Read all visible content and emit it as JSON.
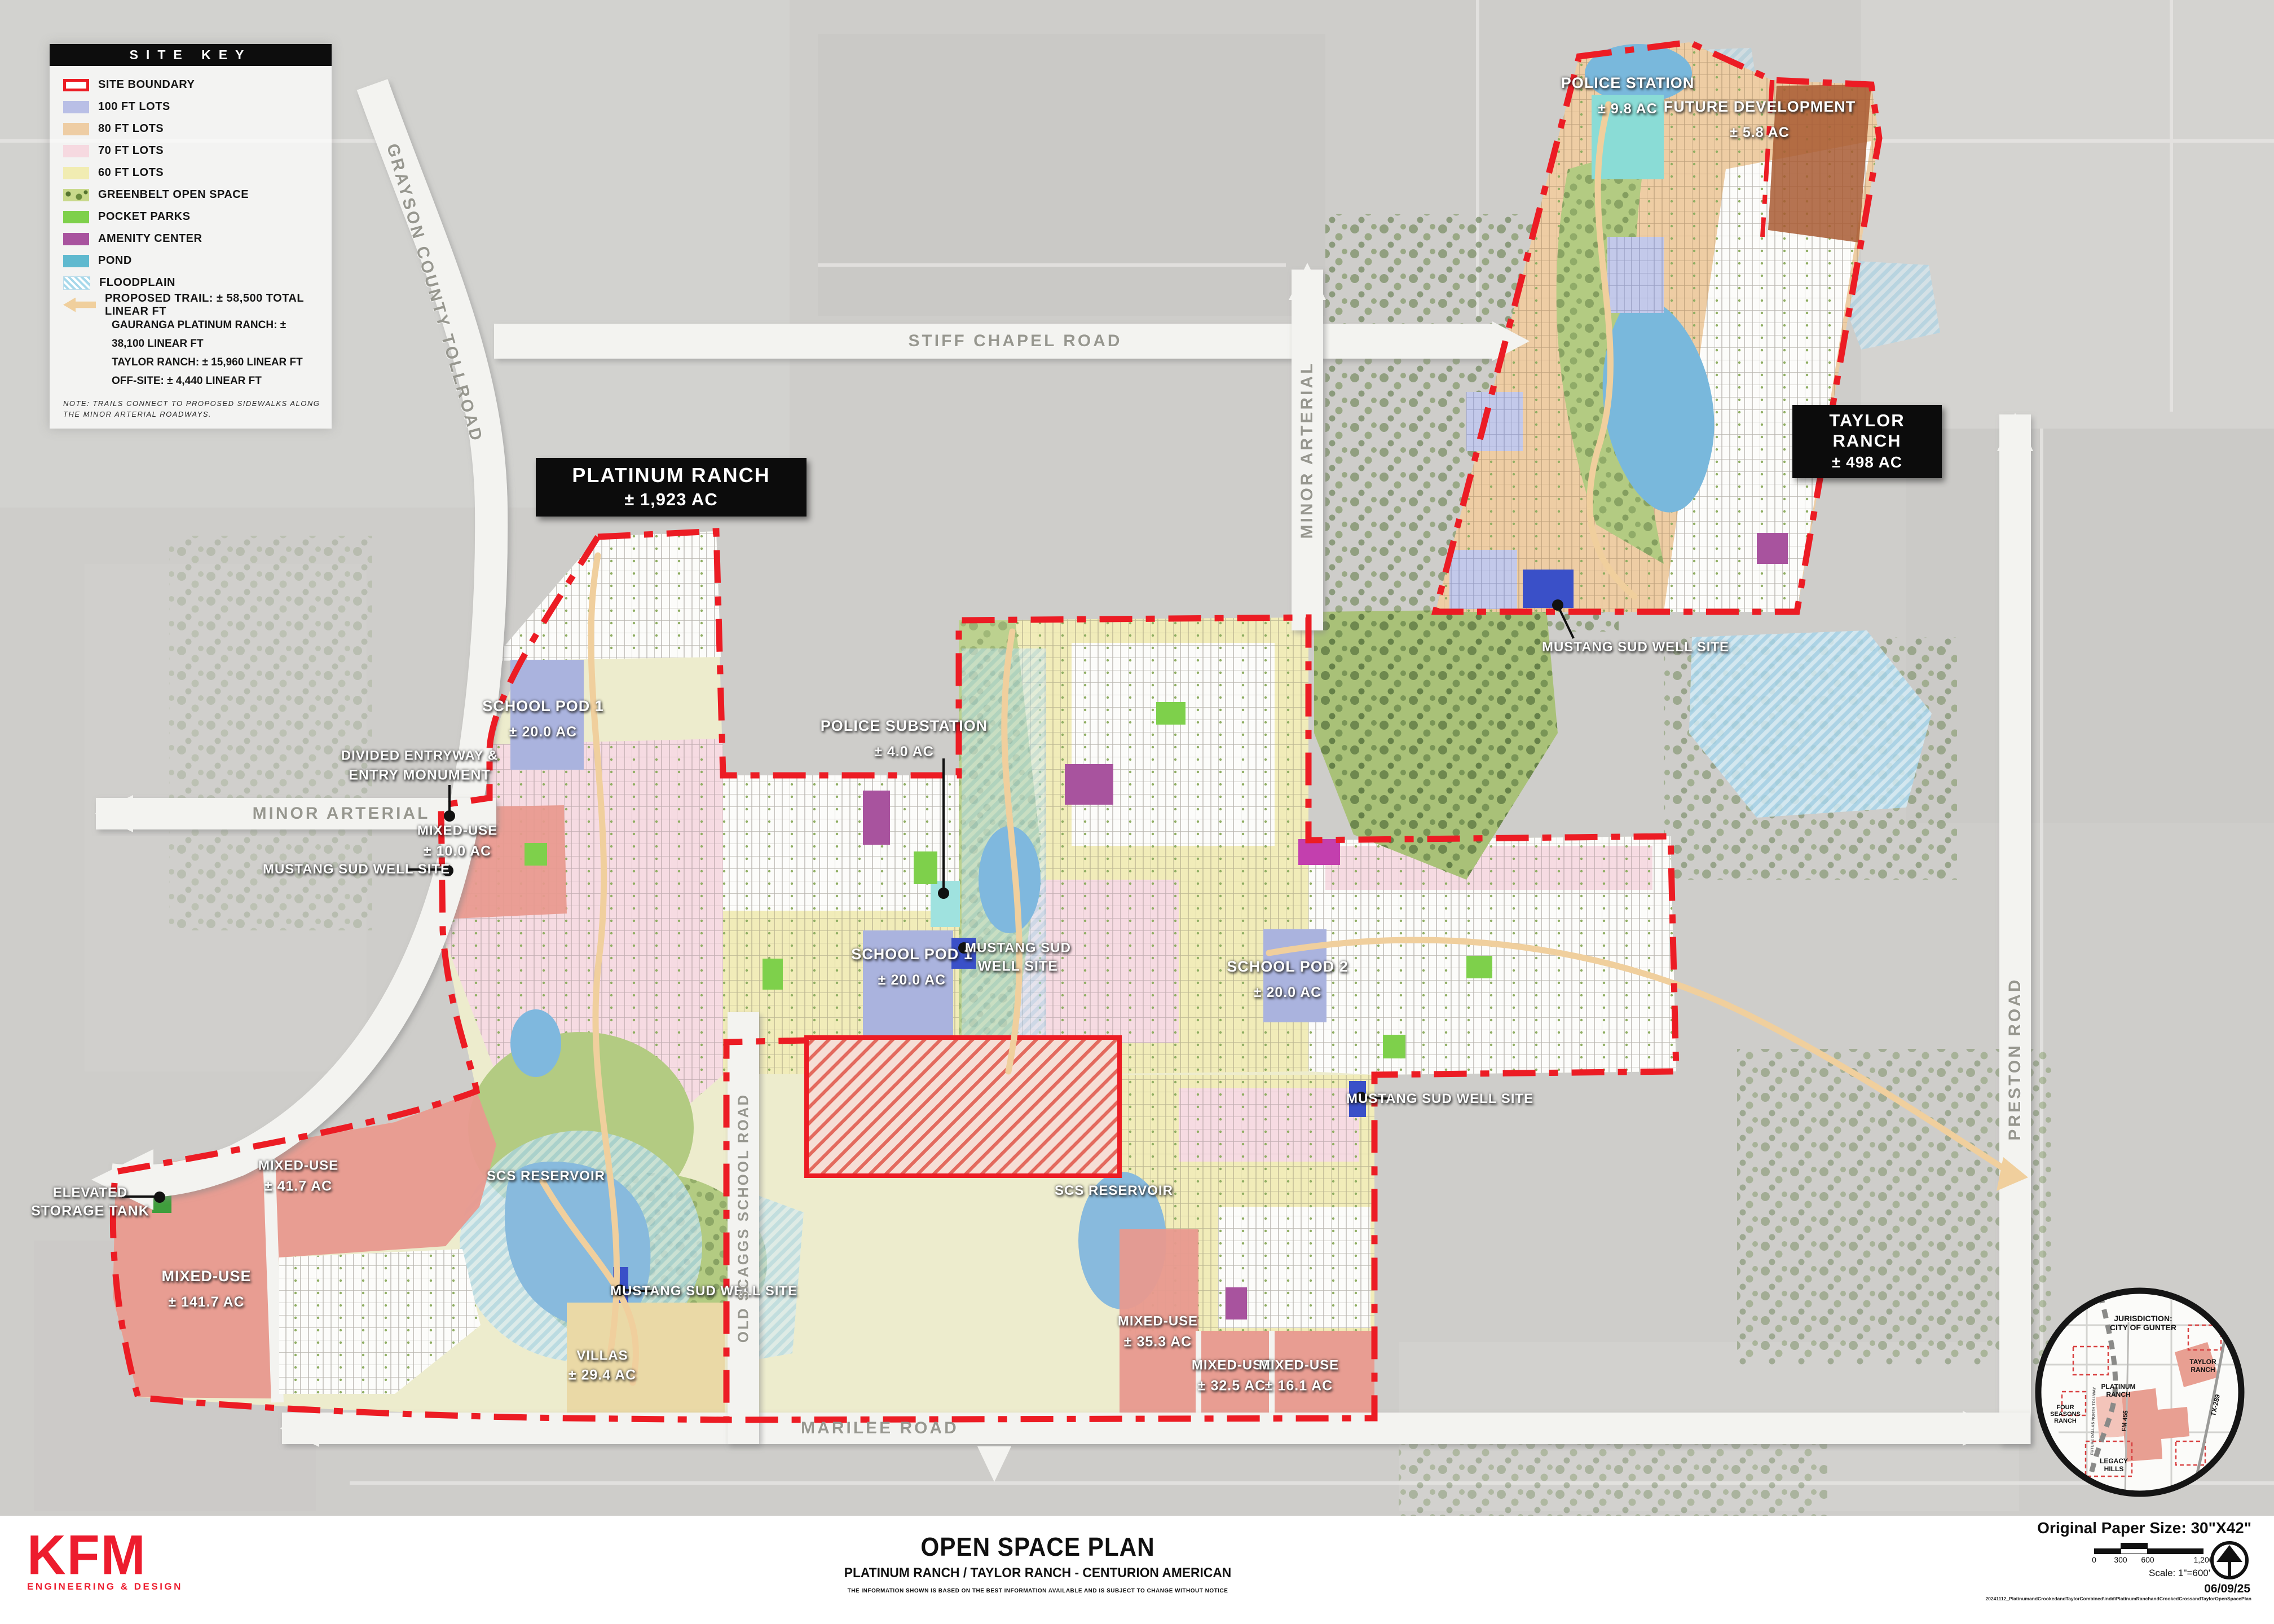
{
  "legend": {
    "title": "SITE KEY",
    "items": [
      {
        "label": "SITE BOUNDARY"
      },
      {
        "label": "100 FT LOTS"
      },
      {
        "label": "80 FT LOTS"
      },
      {
        "label": "70 FT LOTS"
      },
      {
        "label": "60 FT LOTS"
      },
      {
        "label": "GREENBELT OPEN SPACE"
      },
      {
        "label": "POCKET PARKS"
      },
      {
        "label": "AMENITY CENTER"
      },
      {
        "label": "POND"
      },
      {
        "label": "FLOODPLAIN"
      }
    ],
    "trail_label": "PROPOSED TRAIL: ± 58,500 TOTAL LINEAR FT",
    "trail_lines": [
      "GAURANGA PLATINUM RANCH: ± 38,100 LINEAR FT",
      "TAYLOR RANCH: ± 15,960 LINEAR FT",
      "OFF-SITE: ± 4,440 LINEAR FT"
    ],
    "note": "NOTE: TRAILS CONNECT TO PROPOSED SIDEWALKS ALONG THE MINOR ARTERIAL ROADWAYS."
  },
  "boxes": {
    "platinum": {
      "line1": "PLATINUM RANCH",
      "line2": "± 1,923 AC"
    },
    "taylor": {
      "line1": "TAYLOR RANCH",
      "line2": "± 498 AC"
    }
  },
  "labels": {
    "police_station": {
      "line1": "POLICE STATION",
      "line2": "± 9.8 AC"
    },
    "future_development": {
      "line1": "FUTURE DEVELOPMENT",
      "line2": "± 5.8 AC"
    },
    "mustang_taylor": {
      "line1": "MUSTANG SUD WELL SITE"
    },
    "school_pod1_north": {
      "line1": "SCHOOL POD 1",
      "line2": "± 20.0 AC"
    },
    "divided_entry": {
      "line1": "DIVIDED ENTRYWAY &",
      "line2": "ENTRY MONUMENT"
    },
    "mixed_use_10": {
      "line1": "MIXED-USE",
      "line2": "± 10.0 AC"
    },
    "mustang_west": {
      "line1": "MUSTANG SUD WELL SITE"
    },
    "police_substation": {
      "line1": "POLICE SUBSTATION",
      "line2": "± 4.0 AC"
    },
    "school_pod1_center": {
      "line1": "SCHOOL POD 1",
      "line2": "± 20.0 AC"
    },
    "mustang_center": {
      "line1": "MUSTANG SUD",
      "line2": "WELL SITE"
    },
    "school_pod2": {
      "line1": "SCHOOL POD 2",
      "line2": "± 20.0 AC"
    },
    "mustang_east": {
      "line1": "MUSTANG SUD WELL SITE"
    },
    "scs_west": {
      "line1": "SCS RESERVOIR"
    },
    "mixed_use_41": {
      "line1": "MIXED-USE",
      "line2": "± 41.7 AC"
    },
    "elevated_tank": {
      "line1": "ELEVATED",
      "line2": "STORAGE TANK"
    },
    "mixed_use_141": {
      "line1": "MIXED-USE",
      "line2": "± 141.7 AC"
    },
    "villas": {
      "line1": "VILLAS",
      "line2": "± 29.4 AC"
    },
    "mustang_south": {
      "line1": "MUSTANG SUD WELL SITE"
    },
    "scs_east": {
      "line1": "SCS RESERVOIR"
    },
    "mixed_use_35": {
      "line1": "MIXED-USE",
      "line2": "± 35.3 AC"
    },
    "mixed_use_32": {
      "line1": "MIXED-USE",
      "line2": "± 32.5 AC"
    },
    "mixed_use_16": {
      "line1": "MIXED-USE",
      "line2": "± 16.1 AC"
    }
  },
  "roads": {
    "grayson": "GRAYSON COUNTY TOLLROAD",
    "stiff_chapel": "STIFF CHAPEL ROAD",
    "minor_arterial_v": "MINOR ARTERIAL",
    "minor_arterial_h": "MINOR ARTERIAL",
    "preston": "PRESTON ROAD",
    "marilee": "MARILEE ROAD",
    "old_scaggs": "OLD SCAGGS SCHOOL ROAD"
  },
  "inset": {
    "jurisdiction_line1": "JURISDICTION:",
    "jurisdiction_line2": "CITY OF GUNTER",
    "taylor": "TAYLOR RANCH",
    "platinum": "PLATINUM RANCH",
    "four_seasons": "FOUR SEASONS RANCH",
    "legacy_hills": "LEGACY HILLS",
    "fm455": "FM 455",
    "tx289": "TX-289",
    "tollway": "FUTURE DALLAS NORTH TOLLWAY"
  },
  "footer": {
    "logo_line1": "KFM",
    "logo_line2": "ENGINEERING & DESIGN",
    "title": "OPEN SPACE PLAN",
    "subtitle": "PLATINUM RANCH / TAYLOR RANCH - CENTURION AMERICAN",
    "disclaimer": "THE INFORMATION SHOWN IS BASED ON THE BEST INFORMATION AVAILABLE AND IS SUBJECT TO CHANGE WITHOUT NOTICE",
    "paper_size": "Original Paper Size: 30\"X42\"",
    "scale_ticks": [
      "0",
      "300",
      "600",
      "1,200"
    ],
    "scale_text": "Scale: 1\"=600'",
    "date": "06/09/25",
    "file_path": "20241112_PlatinumandCrookedandTaylorCombined\\indd\\PlatinumRanchandCrookedCrossandTaylorOpenSpacePlan"
  },
  "colors": {
    "site_boundary": "#ec1c24",
    "lots_100": "#b9bfe6",
    "lots_80": "#eecda4",
    "lots_70": "#f6d9e0",
    "lots_60": "#f1ecb2",
    "pocket_parks": "#7ed04b",
    "amenity_center": "#a8539e",
    "pond": "#5fb9cf",
    "floodplain": "#bfe3f1",
    "mixed_use": "#e8998e",
    "trail": "#f0cf9d",
    "kfm_red": "#ed1c2e"
  }
}
